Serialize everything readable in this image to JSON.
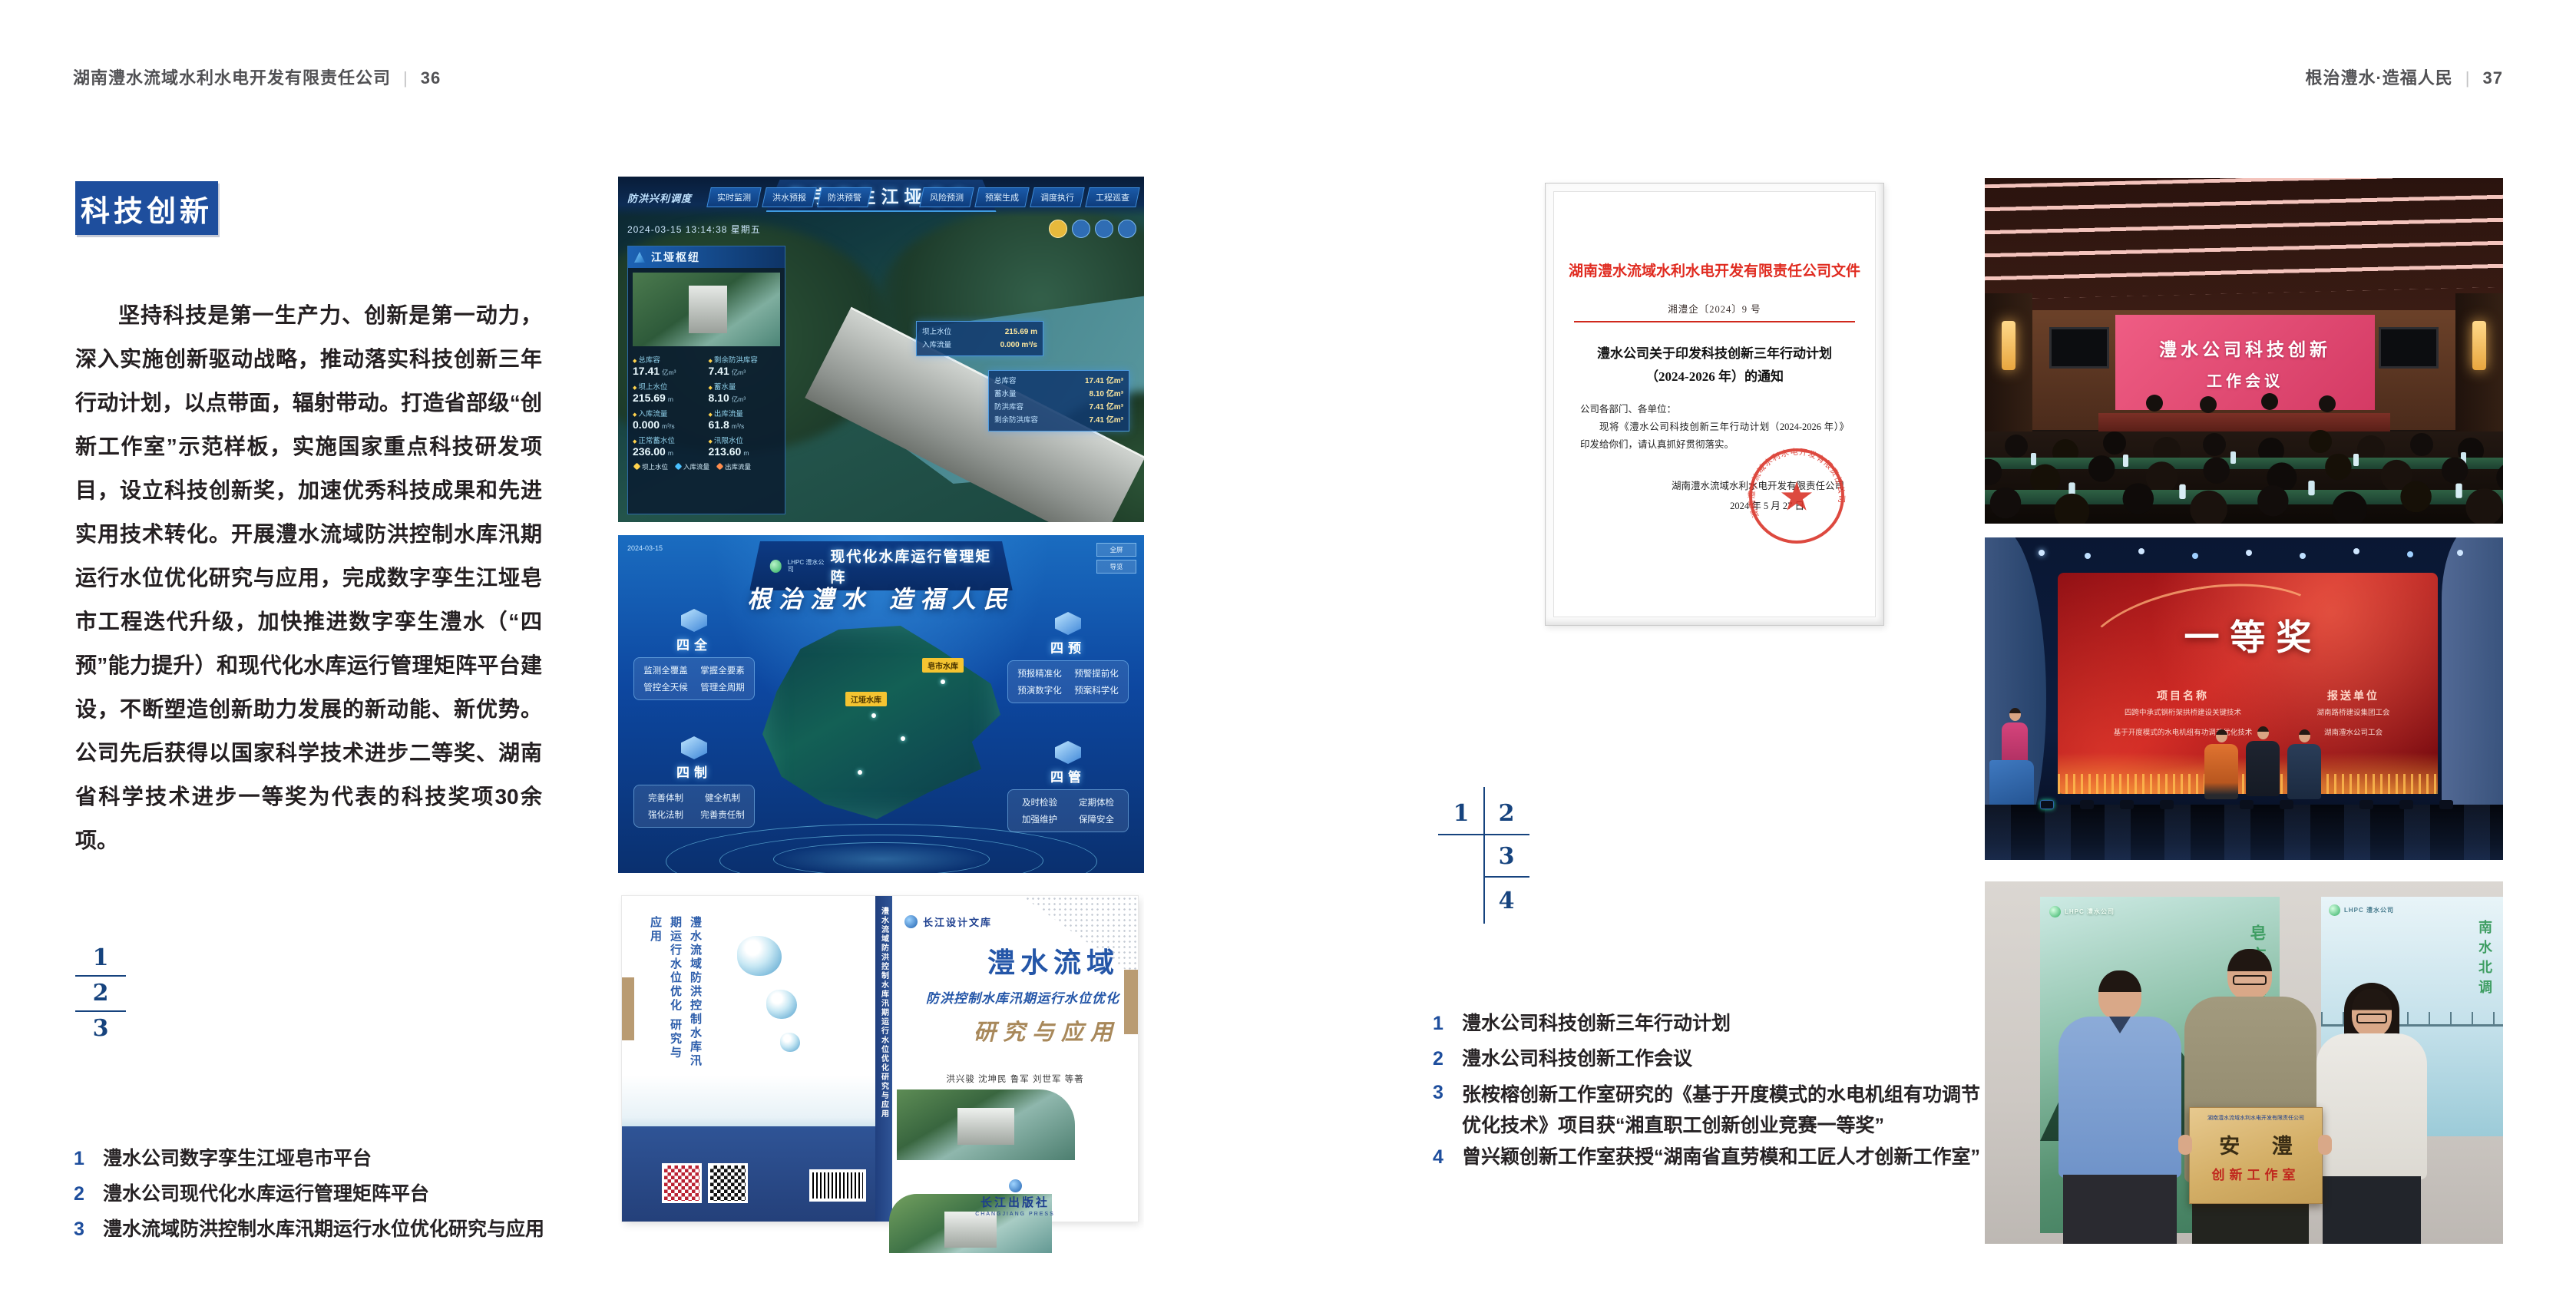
{
  "colors": {
    "accent_blue": "#1e4e9d",
    "locator_blue": "#16437e",
    "doc_red": "#e02b20",
    "book_tan": "#b99b72"
  },
  "page_left": {
    "header": {
      "company": "湖南澧水流域水利水电开发有限责任公司",
      "separator": "|",
      "page_number": "36"
    },
    "section_title": "科技创新",
    "body_paragraph": "坚持科技是第一生产力、创新是第一动力，深入实施创新驱动战略，推动落实科技创新三年行动计划，以点带面，辐射带动。打造省部级“创新工作室”示范样板，实施国家重点科技研发项目，设立科技创新奖，加速优秀科技成果和先进实用技术转化。开展澧水流域防洪控制水库汛期运行水位优化研究与应用，完成数字孪生江垭皂市工程迭代升级，加快推进数字孪生澧水（“四预”能力提升）和现代化水库运行管理矩阵平台建设，不断塑造创新助力发展的新动能、新优势。公司先后获得以国家科学技术进步二等奖、湖南省科学技术进步一等奖为代表的科技奖项30余项。",
    "figure_locator": [
      "1",
      "2",
      "3"
    ],
    "captions": [
      {
        "num": "1",
        "text": "澧水公司数字孪生江垭皂市平台"
      },
      {
        "num": "2",
        "text": "澧水公司现代化水库运行管理矩阵平台"
      },
      {
        "num": "3",
        "text": "澧水流域防洪控制水库汛期运行水位优化研究与应用"
      }
    ],
    "figures": {
      "digital_twin": {
        "title": "数字孪生江垭皂市",
        "module_label": "防洪兴利调度",
        "datetime": "2024-03-15 13:14:38 星期五",
        "tabs_left": [
          "实时监测",
          "洪水预报",
          "防洪预警"
        ],
        "tabs_right": [
          "风险预测",
          "预案生成",
          "调度执行",
          "工程巡查"
        ],
        "panel_title": "江垭枢纽",
        "stats": [
          {
            "label": "总库容",
            "value": "17.41",
            "unit": "亿m³"
          },
          {
            "label": "剩余防洪库容",
            "value": "7.41",
            "unit": "亿m³"
          },
          {
            "label": "坝上水位",
            "value": "215.69",
            "unit": "m"
          },
          {
            "label": "蓄水量",
            "value": "8.10",
            "unit": "亿m³"
          },
          {
            "label": "入库流量",
            "value": "0.000",
            "unit": "m³/s"
          },
          {
            "label": "出库流量",
            "value": "61.8",
            "unit": "m³/s"
          },
          {
            "label": "正常蓄水位",
            "value": "236.00",
            "unit": "m"
          },
          {
            "label": "汛限水位",
            "value": "213.60",
            "unit": "m"
          }
        ],
        "legend": [
          "坝上水位",
          "入库流量",
          "出库流量"
        ],
        "popup_a": [
          {
            "label": "坝上水位",
            "value": "215.69 m"
          },
          {
            "label": "入库流量",
            "value": "0.000 m³/s"
          }
        ],
        "popup_b": [
          {
            "label": "总库容",
            "value": "17.41 亿m³"
          },
          {
            "label": "蓄水量",
            "value": "8.10 亿m³"
          },
          {
            "label": "防洪库容",
            "value": "7.41 亿m³"
          },
          {
            "label": "剩余防洪库容",
            "value": "7.41 亿m³"
          }
        ]
      },
      "matrix": {
        "logo_text": "LHPC 澧水公司",
        "title": "现代化水库运行管理矩阵",
        "slogan": "根治澧水 造福人民",
        "date": "2024-03-15",
        "buttons": [
          "全屏",
          "导览"
        ],
        "groups": [
          {
            "name": "四全",
            "items": [
              "监测全覆盖",
              "掌握全要素",
              "管控全天候",
              "管理全周期"
            ]
          },
          {
            "name": "四预",
            "items": [
              "预报精准化",
              "预警提前化",
              "预演数字化",
              "预案科学化"
            ]
          },
          {
            "name": "四制",
            "items": [
              "完善体制",
              "健全机制",
              "强化法制",
              "完善责任制"
            ]
          },
          {
            "name": "四管",
            "items": [
              "及时检验",
              "定期体检",
              "加强维护",
              "保障安全"
            ]
          }
        ],
        "map_labels": [
          "皂市水库",
          "江垭水库"
        ]
      },
      "book": {
        "series_logo": "长江设计文库",
        "title_main": "澧水流域",
        "title_sub": "防洪控制水库汛期运行水位优化",
        "title_tail": "研究与应用",
        "authors": "洪兴骏  沈坤民  鲁军  刘世军  等著",
        "spine_title": "澧水流域防洪控制水库汛期运行水位优化研究与应用",
        "back_title": "澧水流域防洪控制水库汛期运行水位优化 研究与应用",
        "publisher": "长江出版社",
        "publisher_en": "CHANGJIANG PRESS"
      }
    }
  },
  "page_right": {
    "header": {
      "title": "根治澧水·造福人民",
      "separator": "|",
      "page_number": "37"
    },
    "document": {
      "heading": "湖南澧水流域水利水电开发有限责任公司文件",
      "doc_number": "湘澧企〔2024〕9 号",
      "title_line1": "澧水公司关于印发科技创新三年行动计划",
      "title_line2": "（2024-2026 年）的通知",
      "salutation": "公司各部门、各单位：",
      "body": "现将《澧水公司科技创新三年行动计划（2024-2026 年）》印发给你们，请认真抓好贯彻落实。",
      "signer": "湖南澧水流域水利水电开发有限责任公司",
      "date": "2024 年 5 月 27 日",
      "seal_text": "湖南澧水流域水利水电开发有限责任公司"
    },
    "figure_locator": [
      "1",
      "2",
      "3",
      "4"
    ],
    "captions": [
      {
        "num": "1",
        "text": "澧水公司科技创新三年行动计划"
      },
      {
        "num": "2",
        "text": "澧水公司科技创新工作会议"
      },
      {
        "num": "3",
        "text": "张桉榕创新工作室研究的《基于开度模式的水电机组有功调节",
        "text2": "优化技术》项目获“湘直职工创新创业竞赛一等奖”"
      },
      {
        "num": "4",
        "text": "曾兴颖创新工作室获授“湖南省直劳模和工匠人才创新工作室”"
      }
    ],
    "figures": {
      "meeting": {
        "screen_line1": "澧水公司科技创新",
        "screen_line2": "工作会议"
      },
      "award": {
        "title": "一等奖",
        "col1_header": "项目名称",
        "col1_items": [
          "四跨中承式钢桁架拱桥建设关键技术",
          "基于开度模式的水电机组有功调节优化技术"
        ],
        "col2_header": "报送单位",
        "col2_items": [
          "湖南路桥建设集团工会",
          "湖南澧水公司工会"
        ]
      },
      "group": {
        "poster_left_logo": "LHPC 澧水公司",
        "poster_left_text": "皂市水库",
        "poster_right_logo": "LHPC 澧水公司",
        "poster_right_text": "南水北调",
        "plaque_header": "湖南澧水流域水利水电开发有限责任公司",
        "plaque_main": "安 澧",
        "plaque_sub": "创新工作室"
      }
    }
  }
}
